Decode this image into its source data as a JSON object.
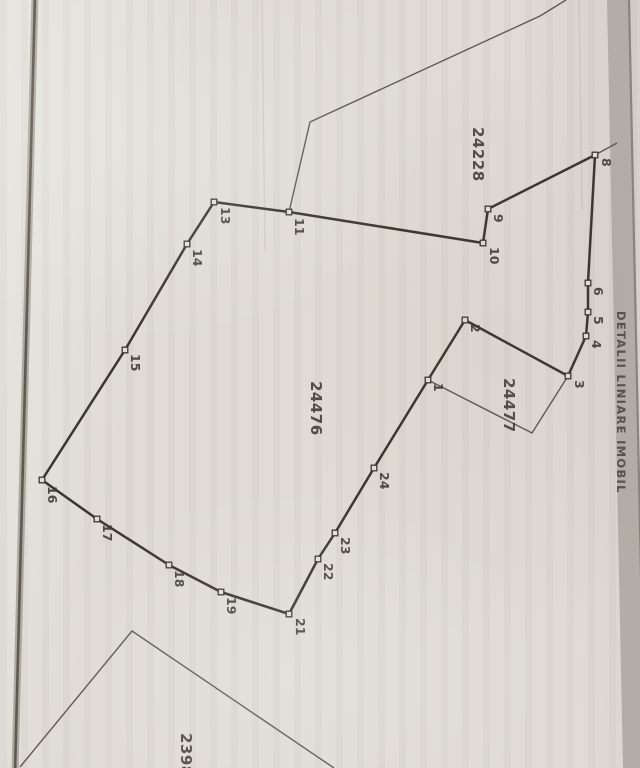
{
  "map": {
    "side_caption": "DETALII LINIARE IMOBIL",
    "colors": {
      "paper": "#e0dcd5",
      "ink": "#3b372f",
      "thin_ink": "#5e5950",
      "marker_fill": "#e3dfd8",
      "label_ink": "#3e3a32",
      "band": "#b2aea7",
      "band_edge": "#8a857c",
      "band_text": "#57534a",
      "left_line_outer": "#837d72",
      "left_line_core": "#5f5a50",
      "streak": "#7d776b"
    },
    "parcels": [
      {
        "id": "24228",
        "label_x": 473,
        "label_y": 127,
        "font": 15
      },
      {
        "id": "24476",
        "label_x": 311,
        "label_y": 381,
        "font": 15
      },
      {
        "id": "24477",
        "label_x": 504,
        "label_y": 378,
        "font": 15
      },
      {
        "id": "2398",
        "label_x": 181,
        "label_y": 733,
        "font": 15
      }
    ],
    "points": [
      {
        "n": "1",
        "x": 428,
        "y": 380,
        "lx": 434,
        "ly": 383
      },
      {
        "n": "2",
        "x": 465,
        "y": 320,
        "lx": 471,
        "ly": 324
      },
      {
        "n": "3",
        "x": 568,
        "y": 376,
        "lx": 575,
        "ly": 380
      },
      {
        "n": "4",
        "x": 586,
        "y": 336,
        "lx": 592,
        "ly": 340
      },
      {
        "n": "5",
        "x": 588,
        "y": 312,
        "lx": 594,
        "ly": 316
      },
      {
        "n": "6",
        "x": 588,
        "y": 283,
        "lx": 594,
        "ly": 287
      },
      {
        "n": "8",
        "x": 595,
        "y": 155,
        "lx": 602,
        "ly": 158
      },
      {
        "n": "9",
        "x": 488,
        "y": 209,
        "lx": 494,
        "ly": 214
      },
      {
        "n": "10",
        "x": 483,
        "y": 243,
        "lx": 490,
        "ly": 247
      },
      {
        "n": "11",
        "x": 289,
        "y": 212,
        "lx": 295,
        "ly": 218
      },
      {
        "n": "13",
        "x": 214,
        "y": 202,
        "lx": 221,
        "ly": 207
      },
      {
        "n": "14",
        "x": 187,
        "y": 244,
        "lx": 193,
        "ly": 249
      },
      {
        "n": "15",
        "x": 125,
        "y": 350,
        "lx": 131,
        "ly": 354
      },
      {
        "n": "16",
        "x": 42,
        "y": 480,
        "lx": 48,
        "ly": 486
      },
      {
        "n": "17",
        "x": 97,
        "y": 519,
        "lx": 103,
        "ly": 524
      },
      {
        "n": "18",
        "x": 169,
        "y": 565,
        "lx": 175,
        "ly": 570
      },
      {
        "n": "19",
        "x": 221,
        "y": 592,
        "lx": 227,
        "ly": 597
      },
      {
        "n": "21",
        "x": 289,
        "y": 614,
        "lx": 296,
        "ly": 618
      },
      {
        "n": "22",
        "x": 318,
        "y": 559,
        "lx": 324,
        "ly": 563
      },
      {
        "n": "23",
        "x": 335,
        "y": 533,
        "lx": 341,
        "ly": 537
      },
      {
        "n": "24",
        "x": 374,
        "y": 468,
        "lx": 380,
        "ly": 472
      }
    ],
    "main_boundary": [
      "13",
      "14",
      "15",
      "16",
      "17",
      "18",
      "19",
      "21",
      "22",
      "23",
      "24",
      "1",
      "2",
      "3",
      "4",
      "5",
      "6",
      "8",
      "9",
      "10",
      "11"
    ],
    "thin_lines": [
      {
        "name": "parcel-24228-west-boundary",
        "pts": [
          [
            289,
            212
          ],
          [
            310,
            122
          ],
          [
            540,
            16
          ],
          [
            566,
            0
          ]
        ]
      },
      {
        "name": "parcel-24477-inner-boundary",
        "pts": [
          [
            428,
            380
          ],
          [
            532,
            433
          ],
          [
            568,
            376
          ]
        ]
      },
      {
        "name": "parcel-2398-outline",
        "pts": [
          [
            20,
            767
          ],
          [
            132,
            631
          ],
          [
            334,
            768
          ]
        ]
      },
      {
        "name": "corner-tick-8",
        "pts": [
          [
            595,
            155
          ],
          [
            617,
            143
          ]
        ]
      }
    ],
    "scan_artifacts": {
      "left_fold_line": {
        "x_top": 35,
        "x_bottom": 15
      },
      "right_band": {
        "poly": [
          [
            607,
            0
          ],
          [
            630,
            0
          ],
          [
            646,
            768
          ],
          [
            623,
            768
          ]
        ]
      },
      "right_band_edge": {
        "pts": [
          [
            629,
            0
          ],
          [
            645,
            768
          ]
        ]
      },
      "faint_streaks": [
        {
          "pts": [
            [
              579,
              0
            ],
            [
              582,
              210
            ]
          ]
        },
        {
          "pts": [
            [
              262,
              0
            ],
            [
              265,
              250
            ]
          ]
        }
      ]
    }
  }
}
